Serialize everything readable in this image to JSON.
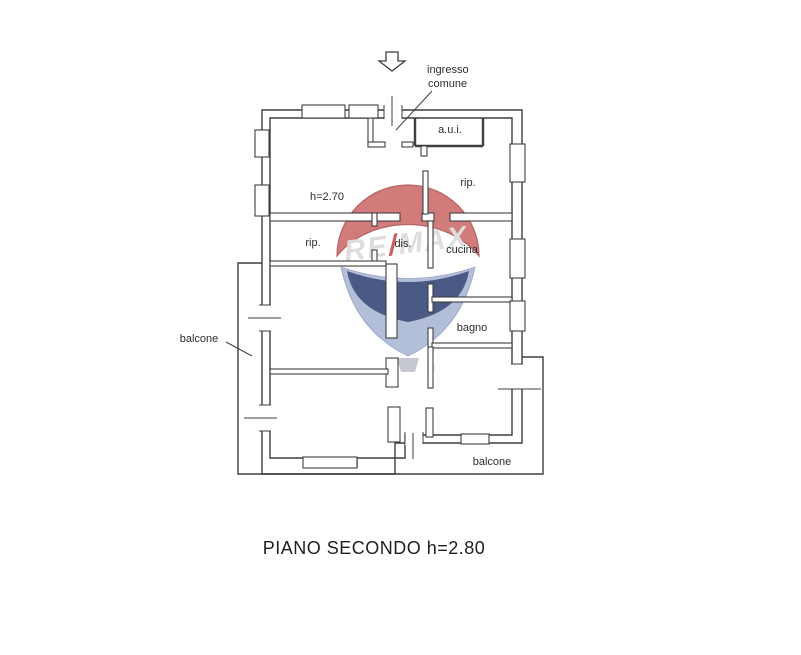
{
  "canvas": {
    "width": 801,
    "height": 655,
    "background": "#ffffff"
  },
  "palette": {
    "wall_line": "#3f3f3f",
    "label_text": "#2d2d2d",
    "balloon_red": "#c95f5f",
    "balloon_red_edge": "#a84343",
    "balloon_navy": "#24356b",
    "balloon_slate": "#a3b0d0",
    "balloon_letters": "#d6d6d6",
    "balloon_slash": "#c43b3b",
    "basket_gray": "#b9bdc6"
  },
  "plan": {
    "labels": {
      "ingresso_line1": "ingresso",
      "ingresso_line2": "comune",
      "aui": "a.u.i.",
      "rip_top": "rip.",
      "height_note": "h=2.70",
      "rip_mid": "rip.",
      "dis": "dis.",
      "cucina": "cucina",
      "bagno": "bagno",
      "balcone_left": "balcone",
      "balcone_bottom": "balcone"
    },
    "title": "PIANO SECONDO h=2.80"
  },
  "watermark": {
    "re": "RE",
    "slash": "/",
    "max": "MAX",
    "registered": "®"
  }
}
